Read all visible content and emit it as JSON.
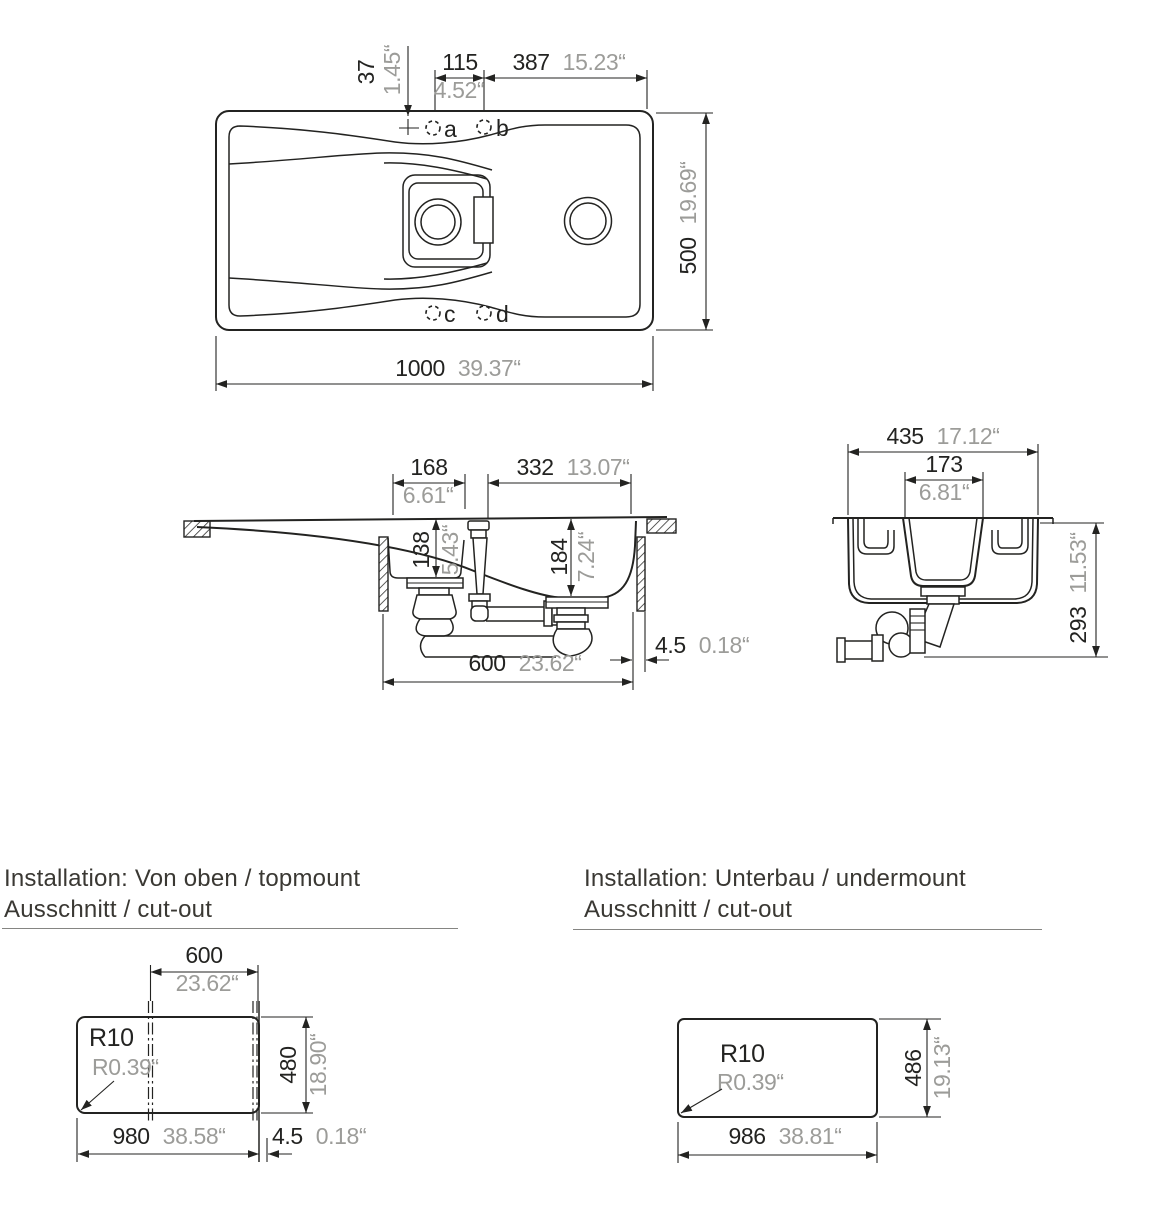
{
  "top_view": {
    "hole_offset_mm": "37",
    "hole_offset_in": "1.45“",
    "hole_pitch_mm": "115",
    "hole_pitch_in": "4.52“",
    "hole_edge_mm": "387",
    "hole_edge_in": "15.23“",
    "depth_mm": "500",
    "depth_in": "19.69“",
    "width_mm": "1000",
    "width_in": "39.37“",
    "hole_a": "a",
    "hole_b": "b",
    "hole_c": "c",
    "hole_d": "d"
  },
  "long_section": {
    "small_bowl_mm": "168",
    "small_bowl_in": "6.61“",
    "main_bowl_mm": "332",
    "main_bowl_in": "13.07“",
    "small_depth_mm": "138",
    "small_depth_in": "5.43“",
    "main_depth_mm": "184",
    "main_depth_in": "7.24“",
    "bowl_unit_mm": "600",
    "bowl_unit_in": "23.62“",
    "edge_gap_mm": "4.5",
    "edge_gap_in": "0.18“"
  },
  "cross_section": {
    "width_mm": "435",
    "width_in": "17.12“",
    "bowl_mm": "173",
    "bowl_in": "6.81“",
    "height_mm": "293",
    "height_in": "11.53“"
  },
  "topmount": {
    "title_line1": "Installation: Von oben / topmount",
    "title_line2": "Ausschnitt / cut-out",
    "bowl_mm": "600",
    "bowl_in": "23.62“",
    "cut_height_mm": "480",
    "cut_height_in": "18.90“",
    "cut_width_mm": "980",
    "cut_width_in": "38.58“",
    "corner_gap_mm": "4.5",
    "corner_gap_in": "0.18“",
    "radius_mm": "R10",
    "radius_in": "R0.39“"
  },
  "undermount": {
    "title_line1": "Installation: Unterbau / undermount",
    "title_line2": "Ausschnitt / cut-out",
    "cut_width_mm": "986",
    "cut_width_in": "38.81“",
    "cut_height_mm": "486",
    "cut_height_in": "19.13“",
    "radius_mm": "R10",
    "radius_in": "R0.39“"
  }
}
